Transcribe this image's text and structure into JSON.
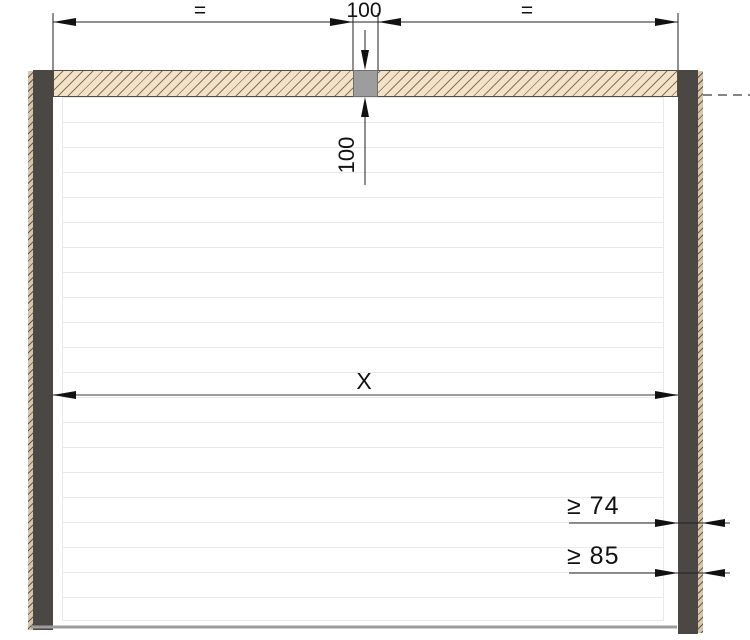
{
  "drawing": {
    "labels": {
      "equal_left": "=",
      "top_width": "100",
      "equal_right": "=",
      "lintel_height": "100",
      "clear_width": "X",
      "min_depth_1": "≥ 74",
      "min_depth_2": "≥ 85"
    },
    "colors": {
      "lintel_fill": "#f2e2c8",
      "lintel_hatch": "#8b7254",
      "post": "#4b4744",
      "center_block": "#9d9d9d",
      "floor_line": "#9c9c9c",
      "door_panel_line": "#e9e9e9",
      "dimension_line": "#222222"
    }
  }
}
